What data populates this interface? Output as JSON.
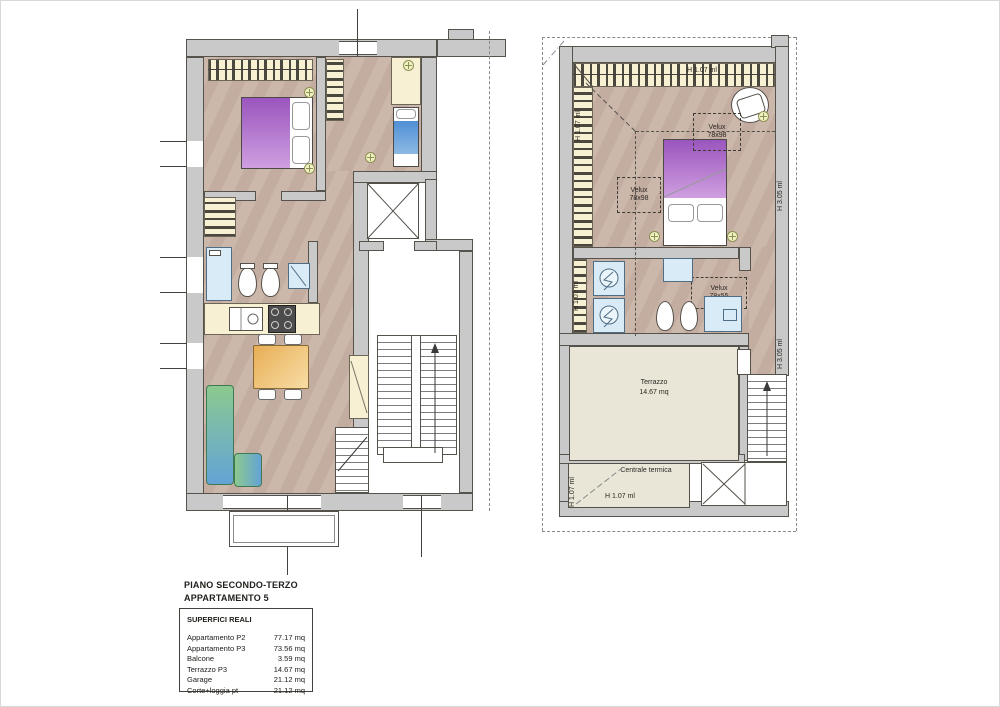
{
  "title": {
    "line1": "PIANO SECONDO-TERZO",
    "line2": "APPARTAMENTO 5"
  },
  "legend": {
    "box_title": "SUPERFICI REALI",
    "rows": [
      {
        "label": "Appartamento P2",
        "value": "77.17 mq"
      },
      {
        "label": "Appartamento P3",
        "value": "73.56 mq"
      },
      {
        "label": "Balcone",
        "value": "3.59 mq"
      },
      {
        "label": "Terrazzo P3",
        "value": "14.67 mq"
      },
      {
        "label": "Garage",
        "value": "21.12 mq"
      },
      {
        "label": "Corte+loggia pt",
        "value": "21.12 mq"
      }
    ]
  },
  "p3": {
    "h107_top": "H 1.07 ml",
    "h107_bedroom_left": "H 1.07 ml",
    "velux_top": [
      "Velux",
      "78x98"
    ],
    "velux_mid": [
      "Velux",
      "78x98"
    ],
    "h305_bedroom": "H 3.05 ml",
    "h107_bath_left": "H 1.07 ml",
    "velux_bath": [
      "Velux",
      "78x55"
    ],
    "h305_stair": "H 3.05 ml",
    "terrazzo": [
      "Terrazzo",
      "14.67 mq"
    ],
    "centrale_termica": "Centrale termica",
    "h107_ct_left": "H 1.07 ml",
    "h107_ct_bottom": "H 1.07 ml"
  },
  "colors": {
    "floor": "#c8b1a4",
    "wall": "#c9c9c9",
    "wall_line": "#56524c",
    "wardrobe": "#f8f0d3",
    "fixture": "#d8ebf6",
    "terrace": "#e9e6d7",
    "bed_purple": "#9a55be",
    "bed_blue": "#4f8fd4",
    "sofa_green": "#8cc98f",
    "sofa_blue": "#64a3d6",
    "table_wood": "#e8ae55",
    "light": "#eff3c2"
  },
  "icons": {
    "ceiling-light": "circle-cross",
    "elevator": "box-x-cross",
    "stair-direction-arrow": "up-arrow",
    "boiler-washer": "circle-zigzag"
  }
}
